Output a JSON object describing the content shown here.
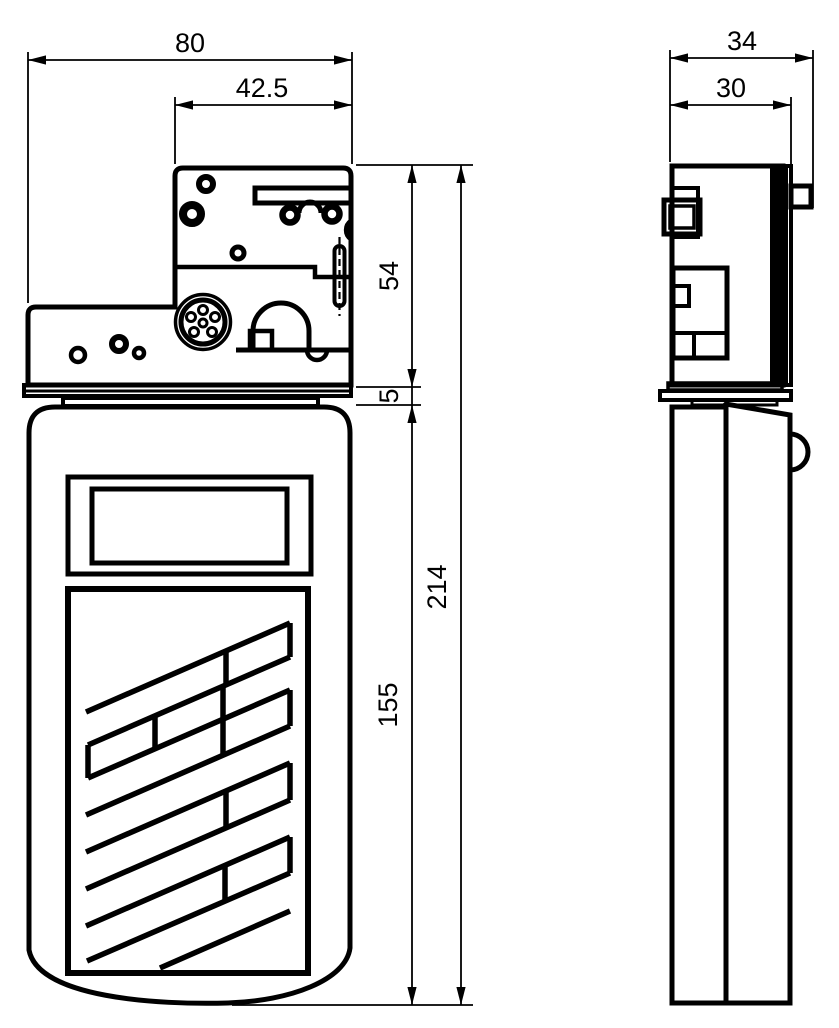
{
  "drawing": {
    "kind": "technical-dimension-drawing",
    "views": [
      "front-view",
      "side-view"
    ],
    "background_color": "#ffffff",
    "line_color": "#000000",
    "units_shown": false
  },
  "dims": {
    "front_width_total": "80",
    "front_width_upper": "42.5",
    "front_height_upper": "54",
    "front_gap": "5",
    "front_height_body": "155",
    "front_height_total": "214",
    "side_depth_total": "34",
    "side_depth_inner": "30"
  }
}
